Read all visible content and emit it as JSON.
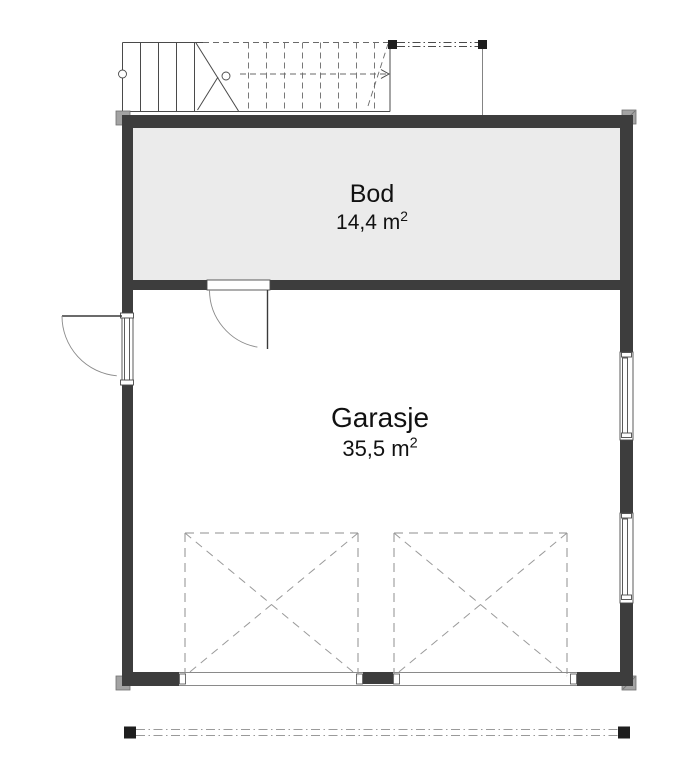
{
  "page": {
    "type": "architectural-floor-plan",
    "background": "#ffffff"
  },
  "rooms": {
    "bod": {
      "label": "Bod",
      "area": "14,4 m",
      "area_sup": "2"
    },
    "garasje": {
      "label": "Garasje",
      "area": "35,5 m",
      "area_sup": "2"
    }
  },
  "symbols": {
    "staircase": "staircase-with-cut-line",
    "porch_posts": "two-posts-with-dash-dot-beam",
    "exterior_door": "outward-swinging-door-left-wall",
    "interior_door": "door-between-bod-and-garasje",
    "window_1": "window-right-wall-upper",
    "window_2": "window-right-wall-lower",
    "garage_door_1": "garage-door-opening-dashed-x",
    "garage_door_2": "garage-door-opening-dashed-x",
    "overhang_line": "roof-overhang-dash-dot-line"
  },
  "colors": {
    "wall": "#3d3d3d",
    "room-fill": "#ebebeb",
    "corner-block": "#a3a3a3",
    "text": "#111111",
    "line-light": "#9a9a9a"
  }
}
